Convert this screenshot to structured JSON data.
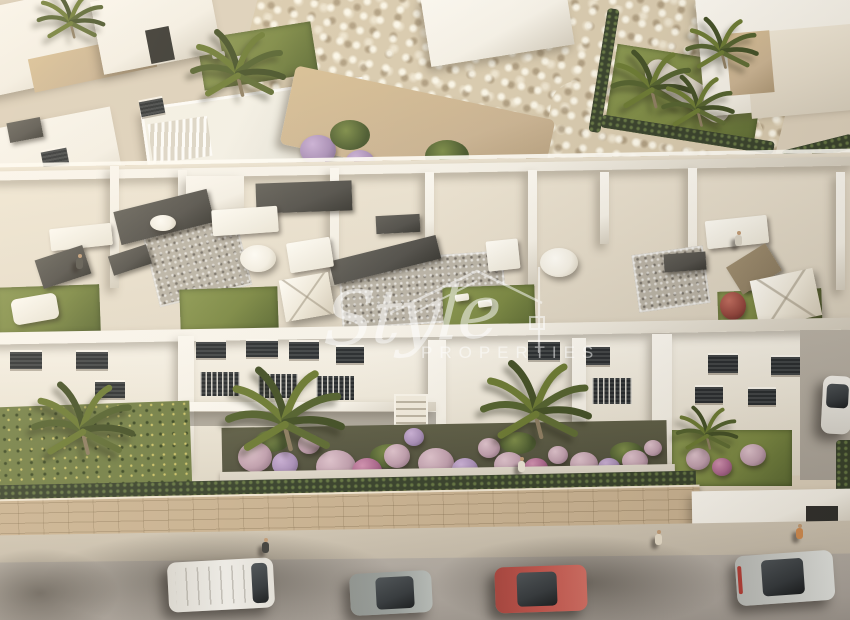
{
  "meta": {
    "image_type": "aerial-architectural-render",
    "subject": "White Mediterranean apartment complex with rooftop terraces, gardens, palm trees, rocky slope villas and street parking"
  },
  "watermark": {
    "brand_script": "Style",
    "brand_caps": "PROPERTIES",
    "logo_icon": "house-roof-outline-icon",
    "color": "#ffffff",
    "opacity": 0.52
  },
  "palette": {
    "wall_bright": "#faf7f0",
    "wall_white": "#f3efe5",
    "wall_shadow": "#d3ccbd",
    "roof_tile": "#e3dac8",
    "stone_tan": "#c8b190",
    "rock_base": "#d7c9ad",
    "lawn_green": "#77853f",
    "lawn_dark": "#57662f",
    "hedge_green": "#343e28",
    "flower_pink": "#bd9cab",
    "flower_lilac": "#a68cb5",
    "flower_magenta": "#a8638a",
    "soil_dark": "#4a4a38",
    "path_gray": "#cfc8ba",
    "sidewalk_gray": "#c3b9a8",
    "asphalt_gray": "#a9a29a",
    "glass_dark": "#31363a",
    "van_white": "#eceae5",
    "car_gray": "#9aa09d",
    "car_red": "#c1524a",
    "car_silver": "#cdcfcb",
    "umbrella_white": "#f2eee3",
    "furniture_charcoal": "#4e4c47",
    "wood_brown": "#8a7a5f",
    "skin_tan": "#c09a74",
    "pool_pale": "#e9e7dd"
  },
  "scene": {
    "vehicles": [
      {
        "name": "white-van",
        "color": "#eceae5"
      },
      {
        "name": "gray-hatchback",
        "color": "#9aa09d"
      },
      {
        "name": "red-car",
        "color": "#c1524a"
      },
      {
        "name": "silver-car",
        "color": "#cdcfcb"
      },
      {
        "name": "white-side-car",
        "color": "#efede8"
      }
    ],
    "pedestrians_on_street": 3,
    "people_on_terraces": 2,
    "palm_tree_count": 10,
    "rooftop_amenities": [
      "sofas",
      "dining-tables",
      "round-parasols",
      "square-parasols",
      "sun-loungers",
      "lawn-patches",
      "gravel-patches"
    ]
  }
}
